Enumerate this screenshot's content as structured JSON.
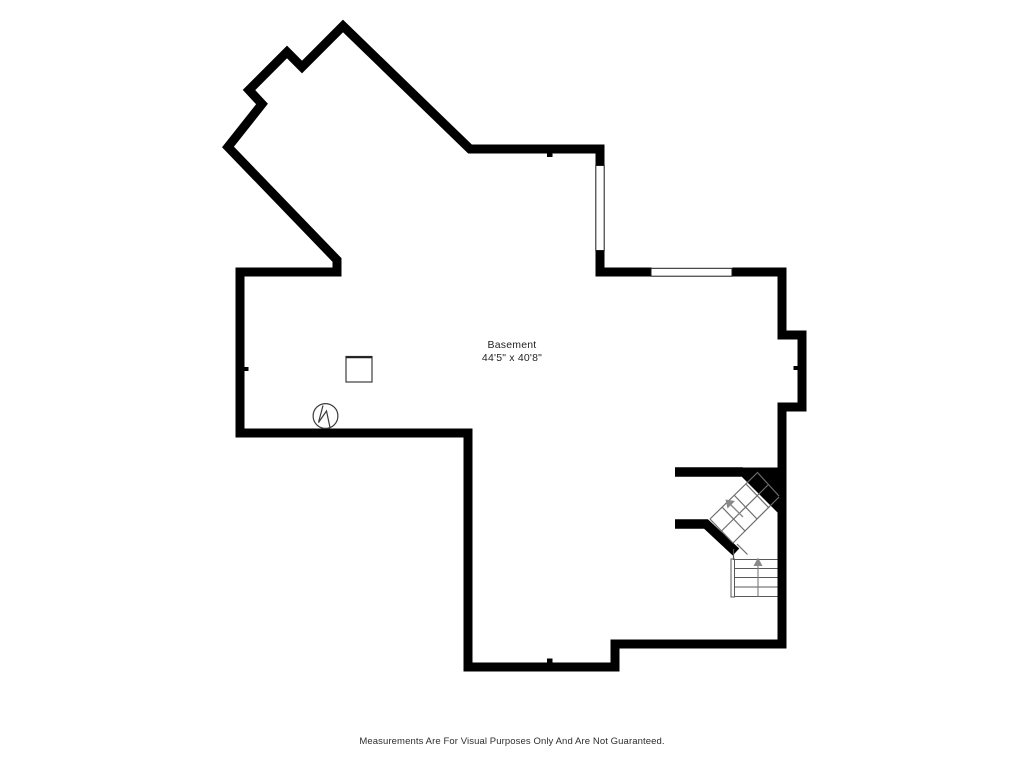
{
  "floor_plan": {
    "room": {
      "label": "Basement",
      "dimensions": "44'5\" x 40'8\""
    },
    "disclaimer": "Measurements Are For Visual Purposes Only And Are Not Guaranteed.",
    "colors": {
      "background": "#ffffff",
      "wall": "#000000",
      "window_line": "#1a1a1a",
      "stair_line": "#6e6e6e",
      "symbol_line": "#3c3c3c",
      "text": "#1f1f1f"
    },
    "symbols": {
      "utility_box": "square-outline-icon",
      "sump_pump": "circle-zigzag-icon",
      "windows": [
        "right-wall-window",
        "upper-right-window"
      ],
      "stair_arrows": [
        "up",
        "up-left"
      ]
    }
  }
}
